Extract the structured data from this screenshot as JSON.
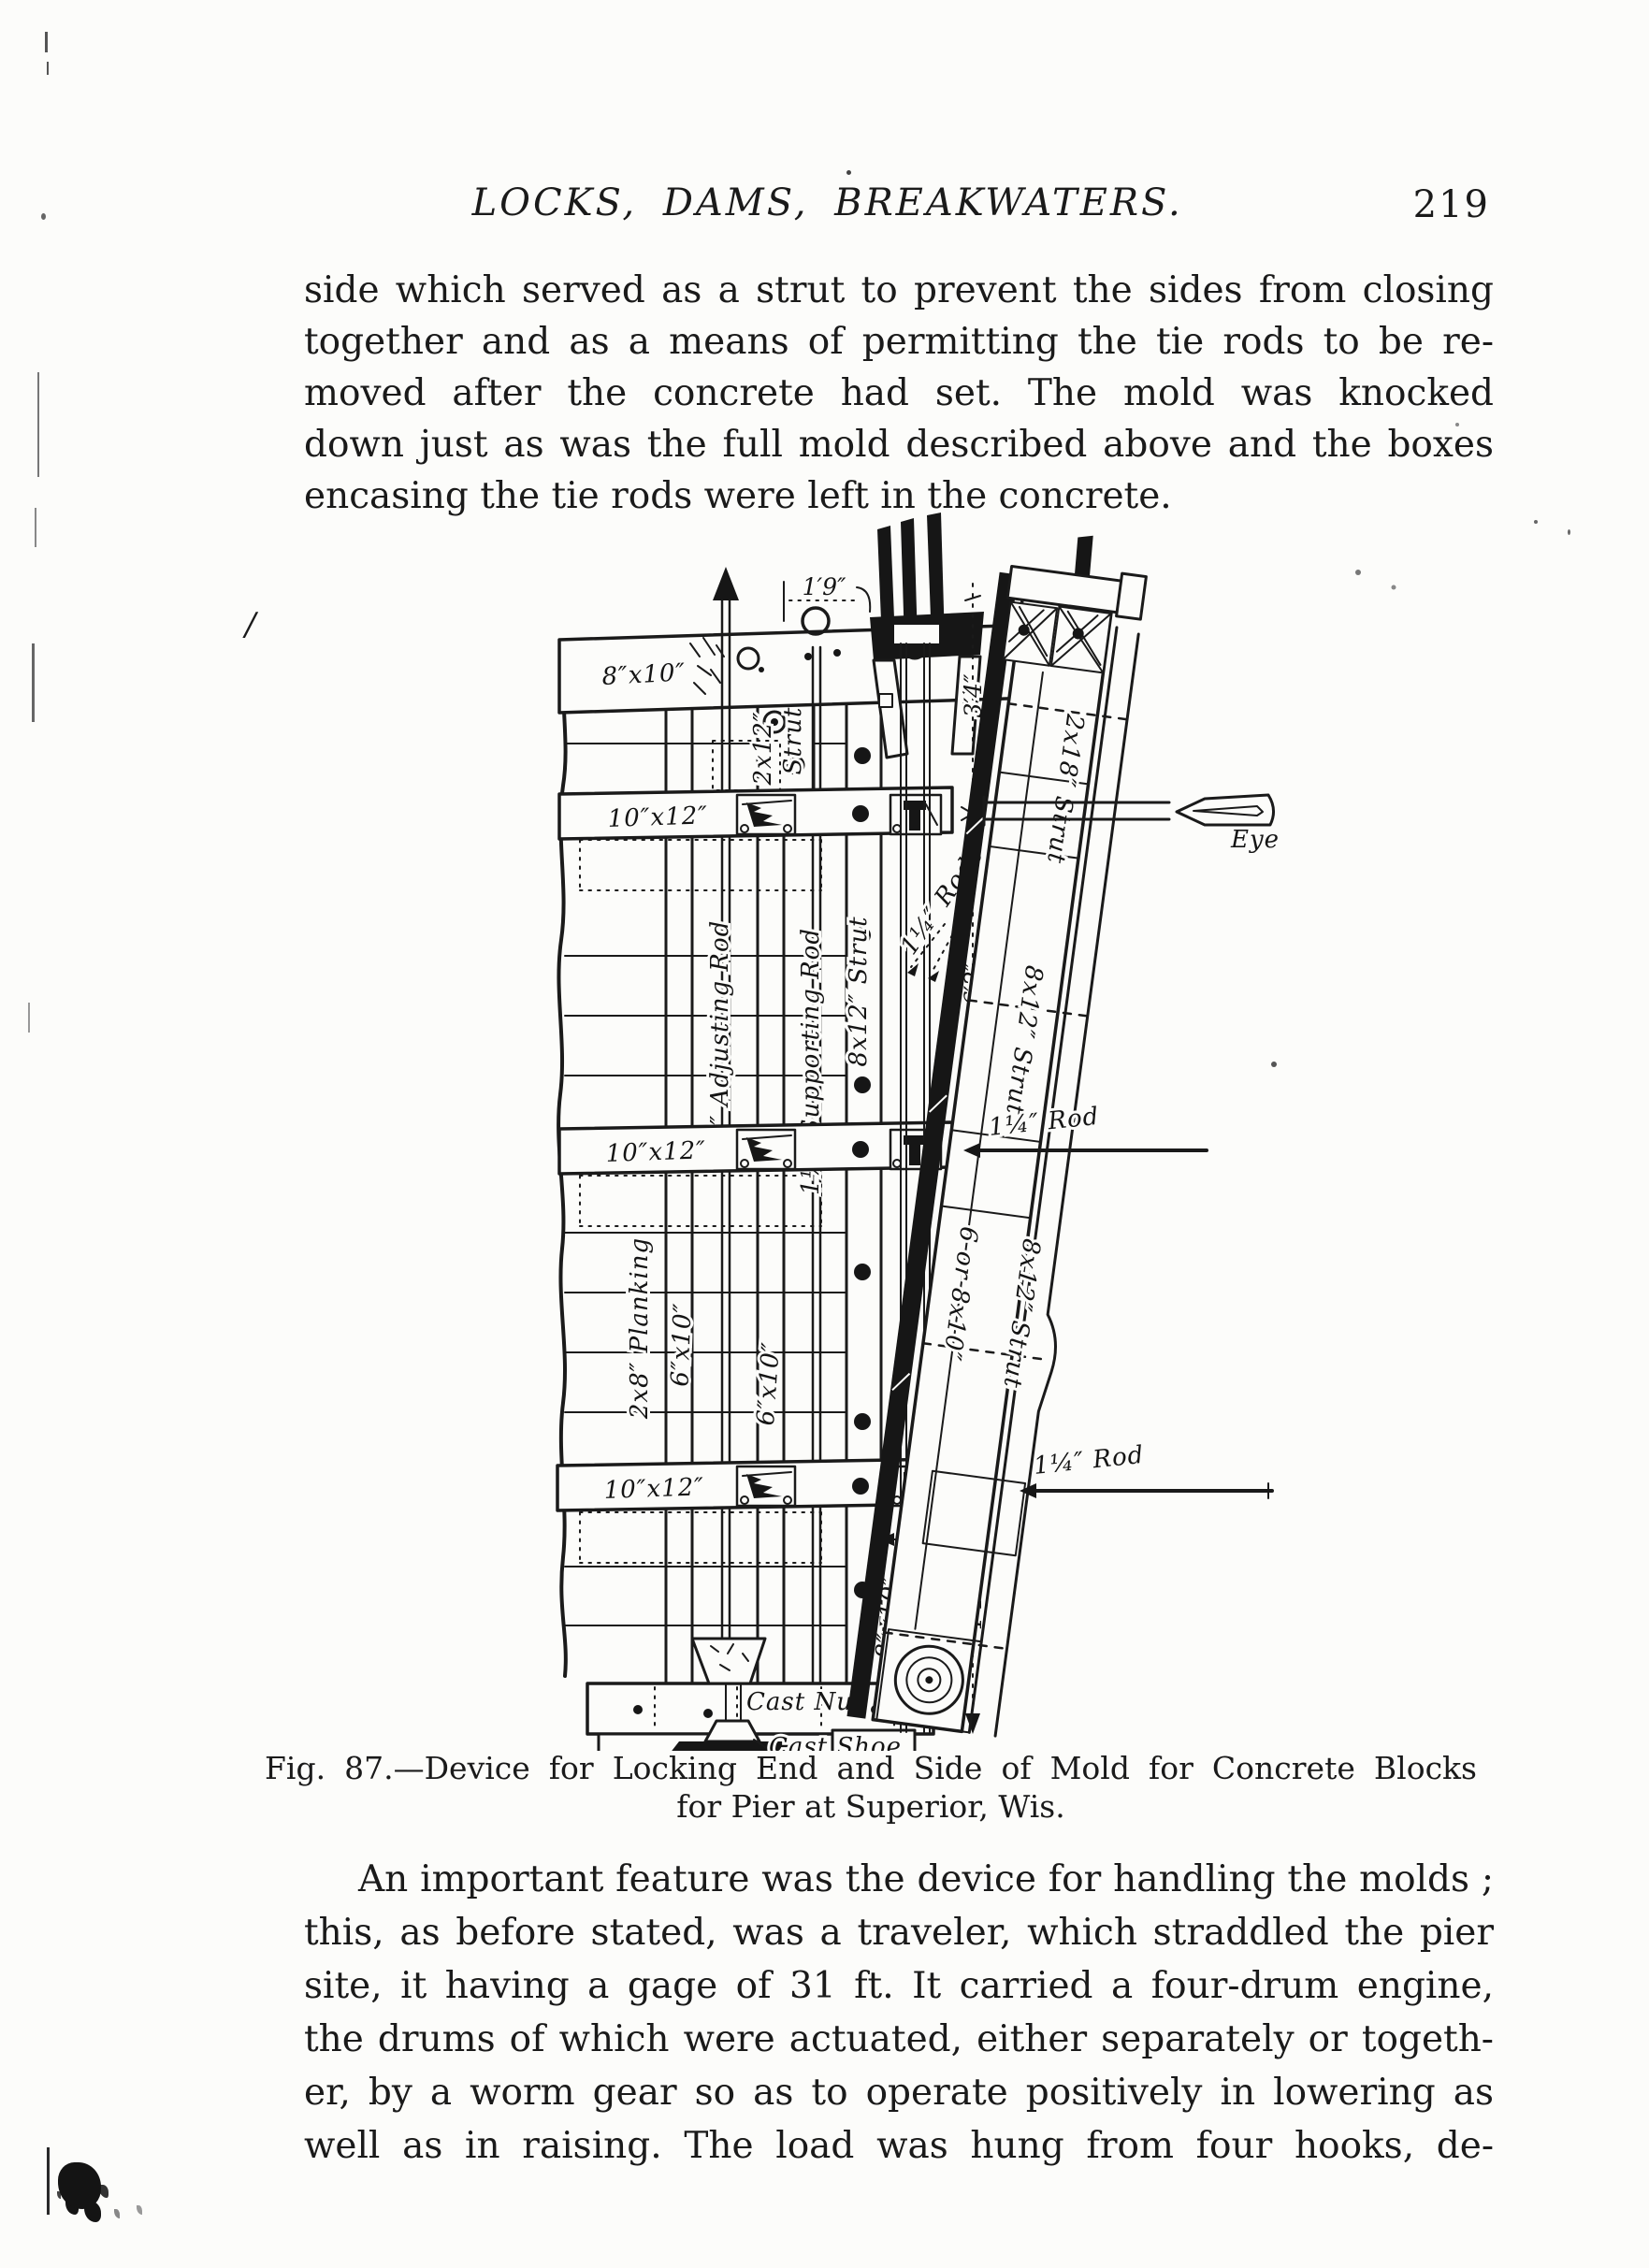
{
  "colors": {
    "ink": "#1a1a1a",
    "paper": "#fcfcfa"
  },
  "header": {
    "title": "LOCKS, DAMS, BREAKWATERS.",
    "page_number": "219"
  },
  "paragraph1": {
    "lines": [
      "side which served as a strut to prevent the sides from closing",
      "together and as a means of permitting the tie rods to be re-",
      "moved after the concrete had set.  The mold was knocked",
      "down just as was the full mold described above and the boxes",
      "encasing the tie rods were left in the concrete."
    ]
  },
  "figure": {
    "caption_line1": "Fig. 87.—Device for Locking End and Side of Mold for Concrete Blocks",
    "caption_line2": "for Pier at Superior, Wis.",
    "labels": {
      "rail_8x10": "8″x10″",
      "dim_1ft9": "1′9″",
      "strut_2x12_size": "2x12″",
      "strut_2x12_word": "Strut",
      "waler_10x12": "10″x12″",
      "adjusting_rod": "1¼″ Adjusting Rod",
      "supporting_rod": "1¼″ Supporting Rod",
      "strut_8x12": "8x12″ Strut",
      "rods_1quarter": "1¼″ Rods",
      "dim_3ft4": "3′4″",
      "dim_6ft2": "6′2″",
      "dim_4ft4": "4′4″",
      "dim_15in": "15″",
      "planking_2x8": "2x8″ Planking",
      "plank_6x10": "6″x10″",
      "post_8x10": "8″x10″",
      "cast_nut": "Cast Nut",
      "cast_shoe": "Cast Shoe",
      "strut_2x18": "2x18″ Strut",
      "alt_6or8x10": "6 or 8x10″",
      "rod_1quarter": "1¼″ Rod",
      "eye": "Eye"
    }
  },
  "paragraph2": {
    "lines": [
      "An important feature was the device for handling the molds ;",
      "this, as before stated, was a traveler, which straddled the pier",
      "site, it having a gage of 31 ft.  It carried a four-drum engine,",
      "the drums of which were actuated, either separately or togeth-",
      "er, by a worm gear so as to operate positively in lowering as",
      "well as in raising.  The load was hung from four hooks, de-"
    ]
  },
  "artifacts": {
    "stray_slash": "/"
  }
}
